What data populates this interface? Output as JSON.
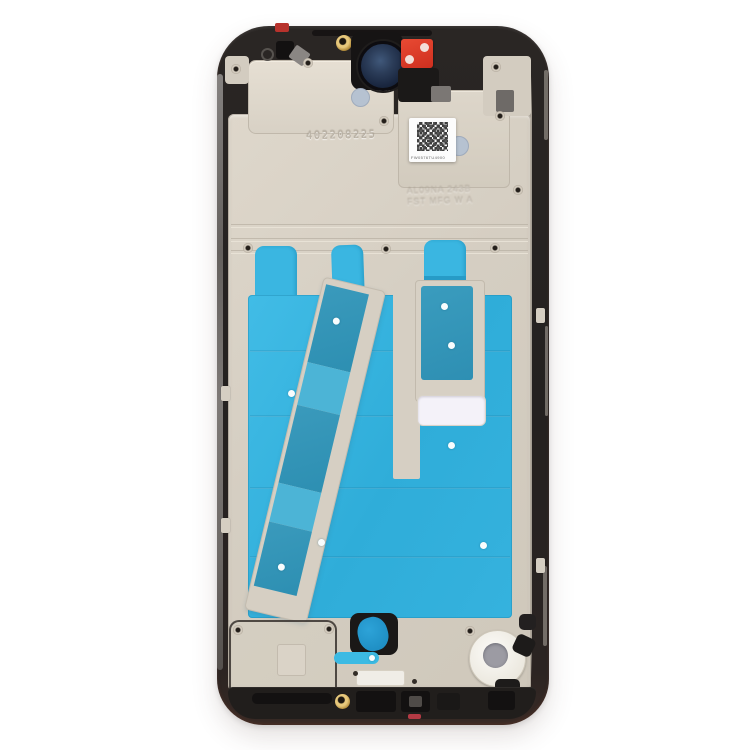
{
  "image": {
    "type": "product-photo",
    "subject": "Smartphone front housing LCD frame bezel middle plate, front side with pre-installed adhesive",
    "background_color": "#ffffff"
  },
  "markings": {
    "engraved_serial": "402208225",
    "stamp_line1": "AL09NA 243B",
    "stamp_line2": "FST MFG W A",
    "qr_label_caption": "FW0576TU4900"
  },
  "colors": {
    "frame_black": "#242120",
    "plate_champagne": "#d6cfc3",
    "adhesive_cyan": "#35b2de",
    "adhesive_teal": "#3093b7",
    "sticker_red": "#d93a28",
    "screw_gold": "#c39b4a",
    "camera_lens_navy": "#22304a",
    "motor_gray": "#9c9ba3",
    "label_white": "#fcfcfc",
    "rim_gray": "#8d8986"
  },
  "parts": [
    "outer black frame",
    "front camera lens opening",
    "red pull sticker",
    "gold screw",
    "QR code label",
    "engraved serial number",
    "cyan protective adhesive sheet",
    "diagonal adhesive bracket",
    "right adhesive bracket",
    "vibration motor seat",
    "bottom speaker cutouts"
  ]
}
